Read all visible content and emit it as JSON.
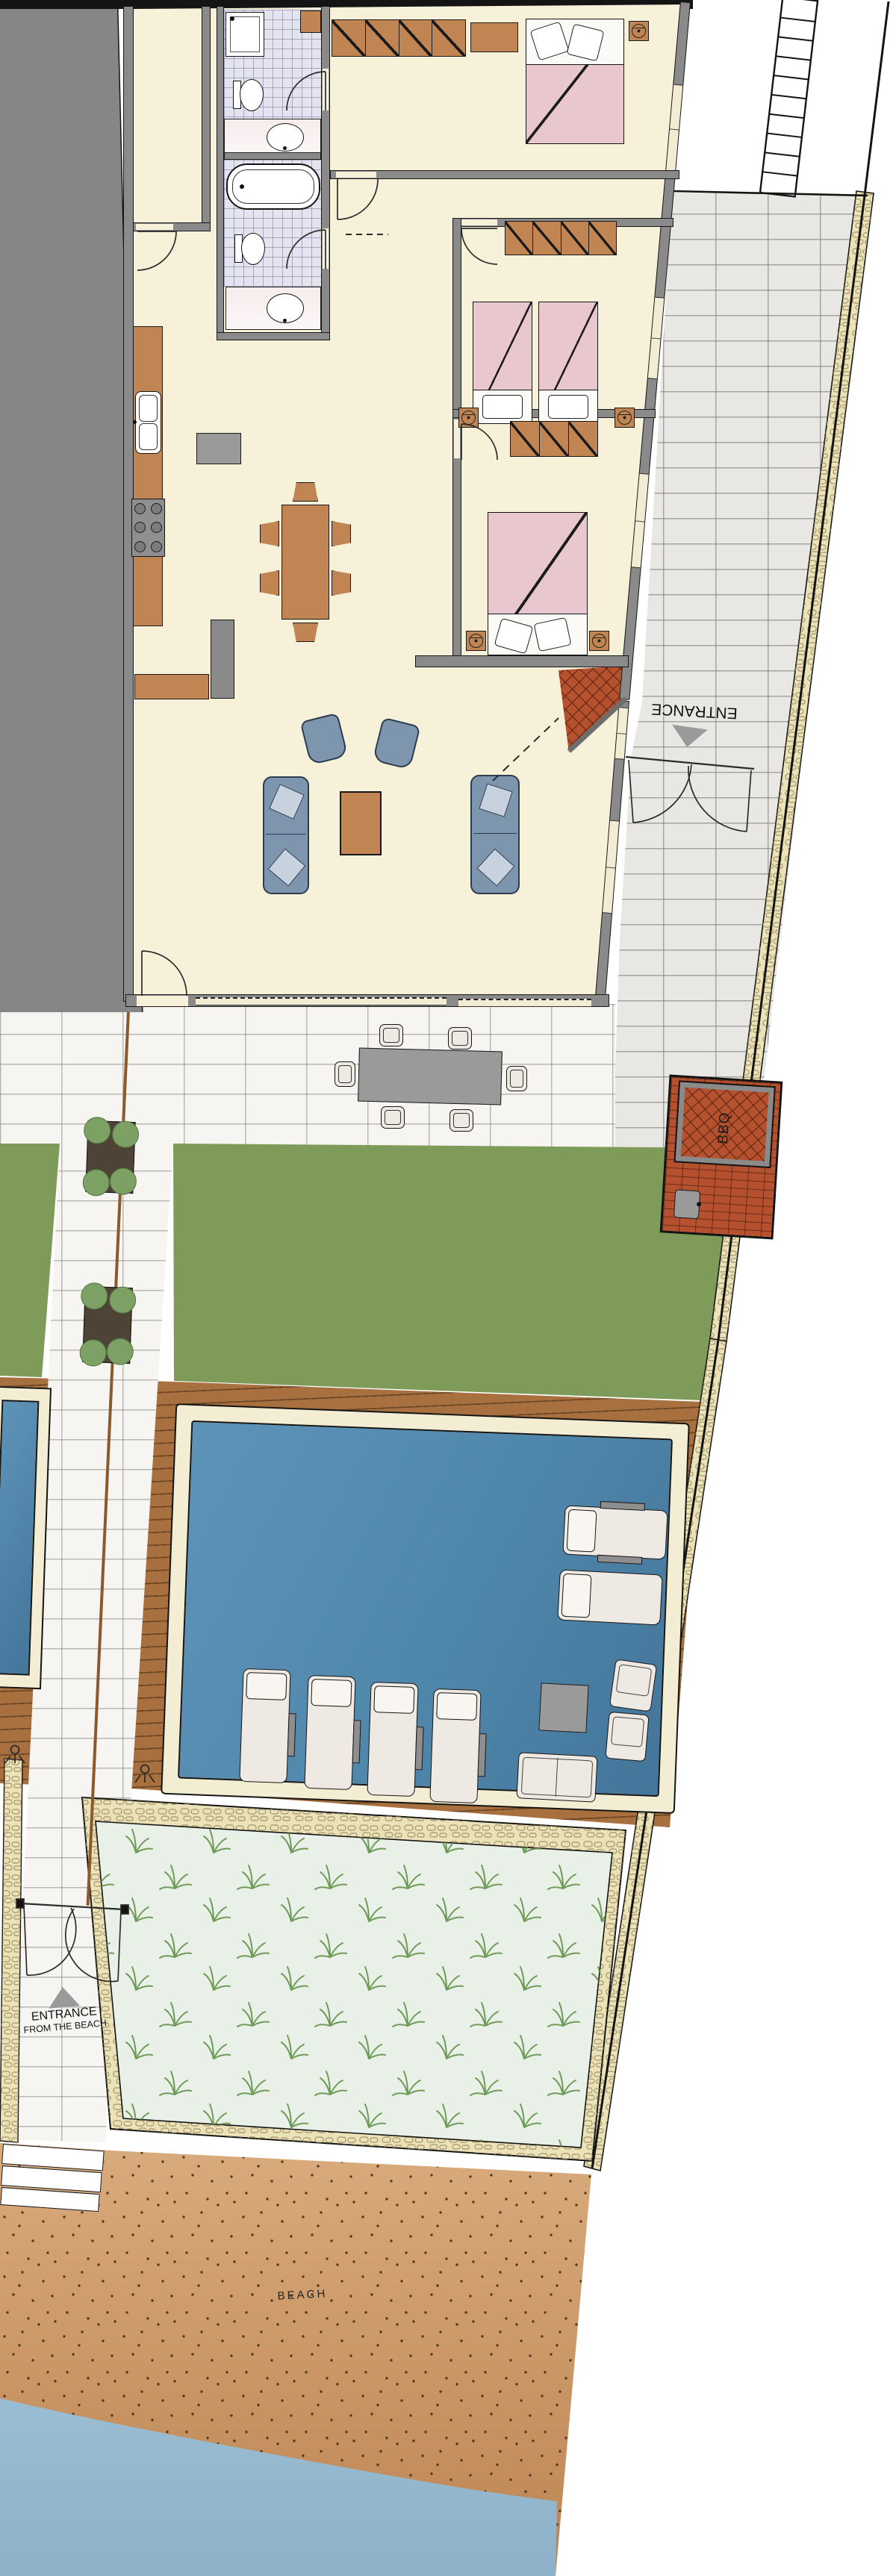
{
  "plan": {
    "type": "villa ground-floor and plot site plan",
    "labels": {
      "driveway_entrance": "ENTRANCE",
      "bbq": "BBQ",
      "beach_entrance_line1": "ENTRANCE",
      "beach_entrance_line2": "FROM THE BEACH",
      "beach": "BEACH"
    },
    "icons": {
      "direction_arrow": "gray-triangle",
      "ceiling_fan": "circle-in-square",
      "outdoor_shower": "shower-head-glyph",
      "stair_ladder": "runged-strip"
    },
    "palette": {
      "wall": "#8a8a8a",
      "floor": "#f8f1da",
      "tile": "#e4e3f0",
      "bed": "#e9c7ce",
      "counter": "#c08552",
      "sofa": "#7e95ae",
      "cushion": "#c7d2de",
      "lawn": "#7e9b5a",
      "deck": "#a8703f",
      "coping": "#f3edd3",
      "water": "#4f87ab",
      "bbq": "#b5512e",
      "vegetation": "#e9f0e7",
      "plant": "#6f9b59",
      "sand_light": "#d9ab7c",
      "sand_dark": "#bd8453",
      "sea": "#97bad1",
      "paver": "#f6f5f1",
      "driveway": "#e8e7e3",
      "stone": "#ece2b8"
    }
  }
}
